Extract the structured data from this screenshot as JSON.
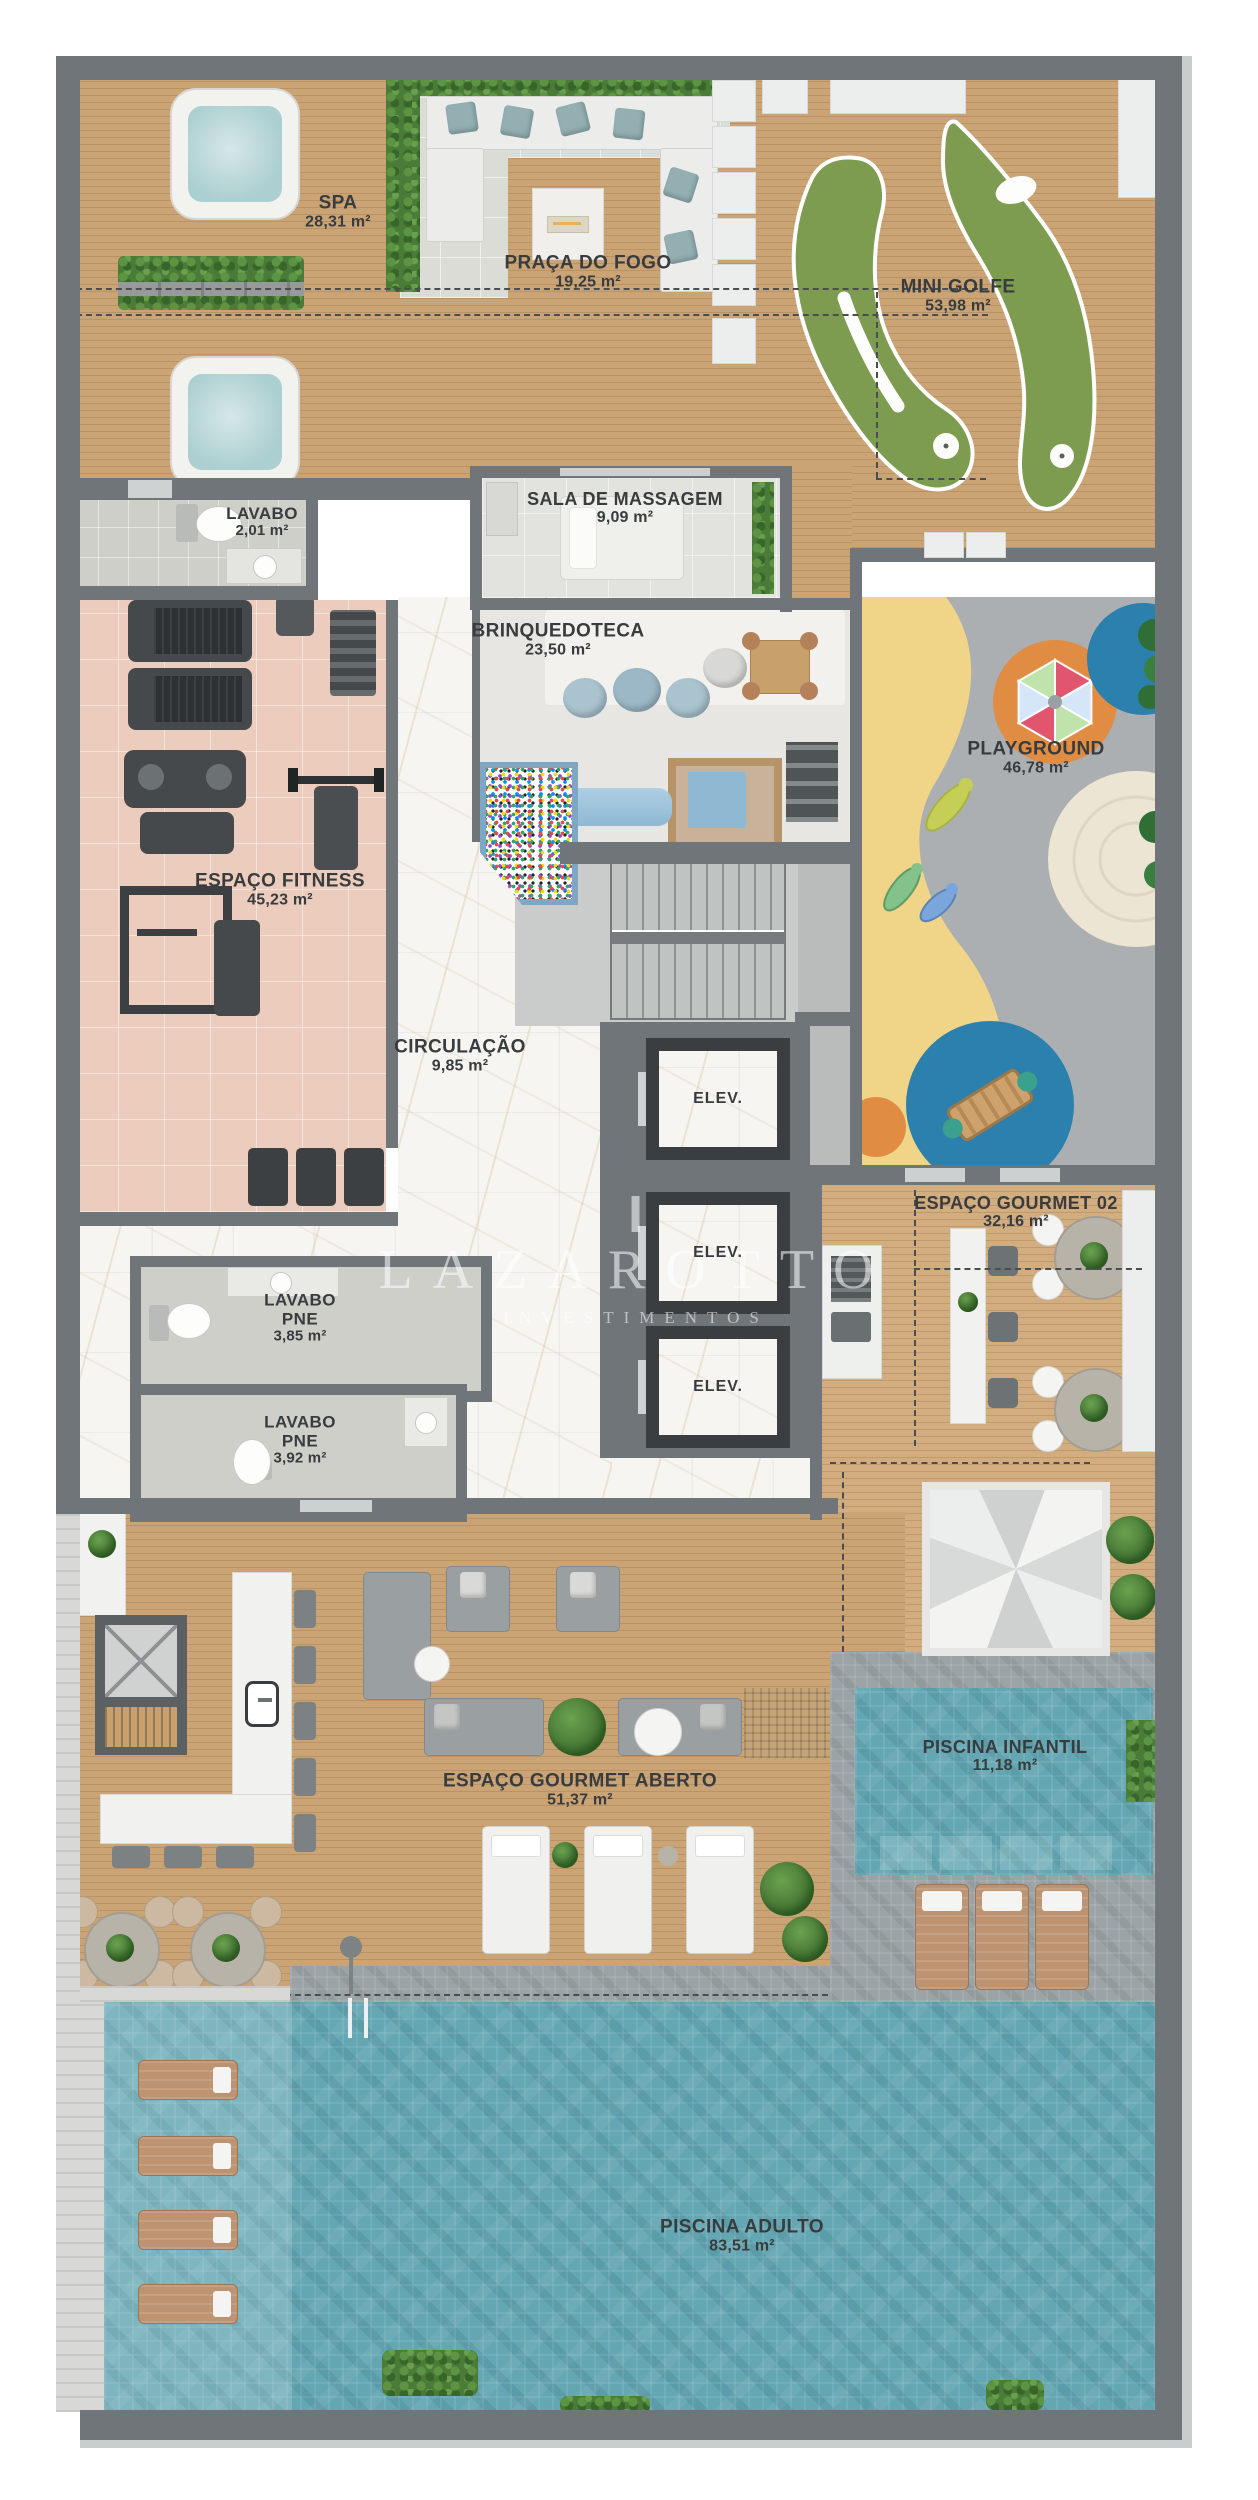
{
  "watermark": {
    "brand": "LAZAROTTO",
    "tagline": "INVESTIMENTOS"
  },
  "rooms": {
    "spa": {
      "name": "SPA",
      "area": "28,31 m²"
    },
    "praca_do_fogo": {
      "name": "PRAÇA DO FOGO",
      "area": "19,25 m²"
    },
    "mini_golfe": {
      "name": "MINI GOLFE",
      "area": "53,98 m²"
    },
    "lavabo": {
      "name": "LAVABO",
      "area": "2,01 m²"
    },
    "sala_de_massagem": {
      "name": "SALA DE MASSAGEM",
      "area": "9,09 m²"
    },
    "brinquedoteca": {
      "name": "BRINQUEDOTECA",
      "area": "23,50 m²"
    },
    "playground": {
      "name": "PLAYGROUND",
      "area": "46,78 m²"
    },
    "espaco_fitness": {
      "name": "ESPAÇO FITNESS",
      "area": "45,23 m²"
    },
    "circulacao": {
      "name": "CIRCULAÇÃO",
      "area": "9,85 m²"
    },
    "elevador": {
      "name": "ELEV."
    },
    "espaco_gourmet_02": {
      "name": "ESPAÇO GOURMET 02",
      "area": "32,16 m²"
    },
    "lavabo_pne_1": {
      "name": "LAVABO PNE",
      "area": "3,85 m²"
    },
    "lavabo_pne_2": {
      "name": "LAVABO PNE",
      "area": "3,92 m²"
    },
    "espaco_gourmet_aberto": {
      "name": "ESPAÇO GOURMET ABERTO",
      "area": "51,37 m²"
    },
    "piscina_infantil": {
      "name": "PISCINA INFANTIL",
      "area": "11,18 m²"
    },
    "piscina_adulto": {
      "name": "PISCINA ADULTO",
      "area": "83,51 m²"
    }
  },
  "palette": {
    "wood_deck": "#c79e6f",
    "marble_floor": "#f6f5f2",
    "fitness_floor": "#ecccbc",
    "pool_water": "#64a7b3",
    "turf_green": "#7d9c50",
    "playground_yellow": "#f0d488",
    "playground_orange": "#e08c42",
    "playground_blue": "#2b80ad",
    "wall_gray": "#70757a",
    "label_text": "#393c3e"
  }
}
